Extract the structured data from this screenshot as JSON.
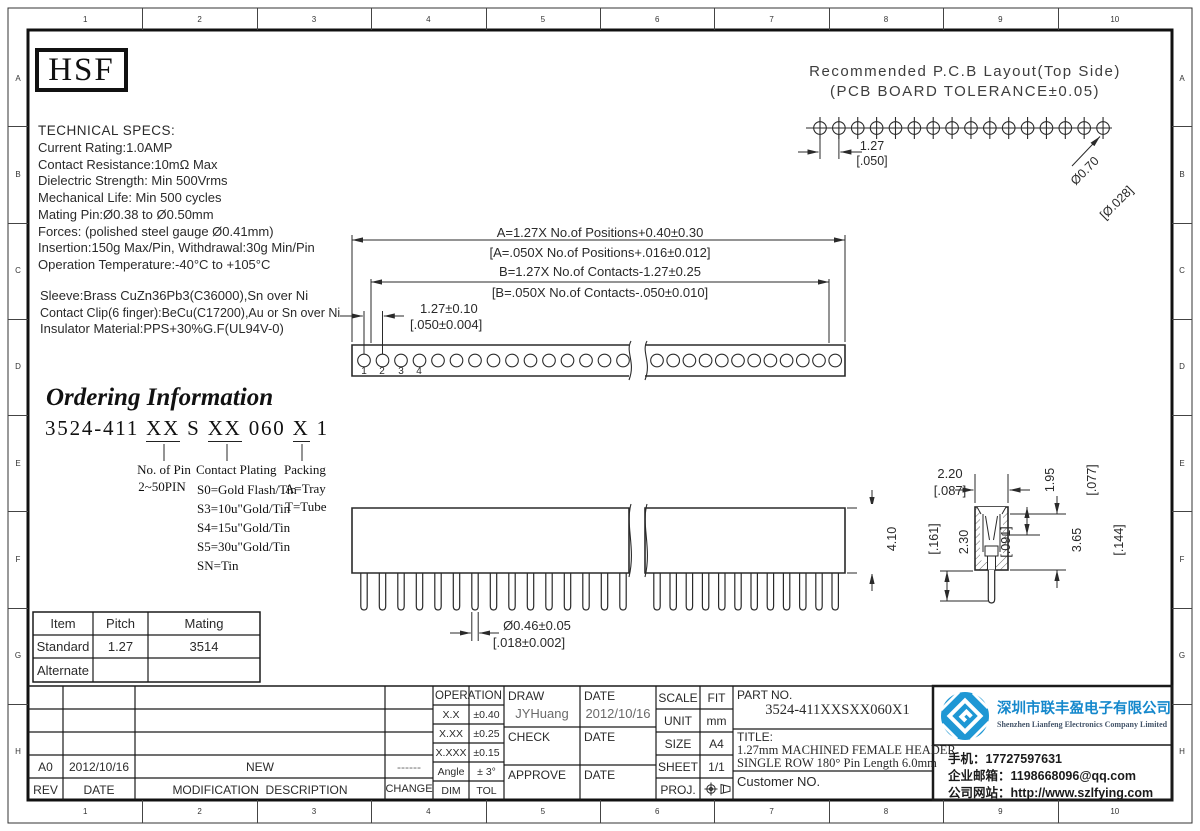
{
  "frame": {
    "top_numbers": [
      "1",
      "2",
      "3",
      "4",
      "5",
      "6",
      "7",
      "8",
      "9",
      "10"
    ],
    "side_letters": [
      "A",
      "B",
      "C",
      "D",
      "E",
      "F",
      "G",
      "H"
    ]
  },
  "logo_box": {
    "text": "HSF"
  },
  "pcb_layout": {
    "title_line1": "Recommended P.C.B Layout(Top Side)",
    "title_line2": "(PCB BOARD TOLERANCE±0.05)",
    "pitch_mm": "1.27",
    "pitch_in": "[.050]",
    "hole_dia_mm": "Ø0.70",
    "hole_dia_in": "[Ø.028]",
    "hole_count": 16
  },
  "tech_specs": {
    "title": "TECHNICAL SPECS:",
    "lines": [
      "Current Rating:1.0AMP",
      "Contact Resistance:10mΩ Max",
      "Dielectric Strength: Min 500Vrms",
      "Mechanical Life: Min 500 cycles",
      "Mating Pin:Ø0.38 to Ø0.50mm",
      "Forces: (polished steel gauge Ø0.41mm)",
      "Insertion:150g Max/Pin, Withdrawal:30g Min/Pin",
      "Operation Temperature:-40°C to +105°C"
    ],
    "material_lines": [
      "Sleeve:Brass CuZn36Pb3(C36000),Sn over Ni",
      "Contact Clip(6 finger):BeCu(C17200),Au or Sn over Ni",
      "Insulator Material:PPS+30%G.F(UL94V-0)"
    ]
  },
  "dimensions": {
    "a_metric": "A=1.27X No.of Positions+0.40±0.30",
    "a_inch": "[A=.050X No.of Positions+.016±0.012]",
    "b_metric": "B=1.27X No.of Contacts-1.27±0.25",
    "b_inch": "[B=.050X No.of Contacts-.050±0.010]",
    "pitch_metric": "1.27±0.10",
    "pitch_inch": "[.050±0.004]",
    "body_height_metric": "4.10",
    "body_height_inch": "[.161]",
    "pin_dia_metric": "Ø0.46±0.05",
    "pin_dia_inch": "[.018±0.002]",
    "width_metric": "2.20",
    "width_inch": "[.087]",
    "depth_metric": "1.95",
    "depth_inch": "[.077]",
    "tail_metric": "2.30",
    "tail_inch": "[.091]",
    "inner_metric": "3.65",
    "inner_inch": "[.144]"
  },
  "top_view": {
    "pin_numbers": [
      "1",
      "2",
      "3",
      "4"
    ],
    "left_holes": 15,
    "right_holes": 12
  },
  "side_view": {
    "left_pins": 15,
    "right_pins": 12
  },
  "ordering": {
    "title": "Ordering Information",
    "part_segments": [
      {
        "text": "3524-411 "
      },
      {
        "text": "XX"
      },
      {
        "text": " S "
      },
      {
        "text": "XX"
      },
      {
        "text": " 060 "
      },
      {
        "text": "X"
      },
      {
        "text": " 1"
      }
    ],
    "pin_label_title": "No. of Pin",
    "pin_label_value": "2~50PIN",
    "plating_title": "Contact Plating",
    "plating_options": [
      "S0=Gold Flash/Tin",
      "S3=10u\"Gold/Tin",
      "S4=15u\"Gold/Tin",
      "S5=30u\"Gold/Tin",
      "SN=Tin"
    ],
    "packing_title": "Packing",
    "packing_options": [
      "A=Tray",
      "T=Tube"
    ]
  },
  "mating_table": {
    "headers": [
      "Item",
      "Pitch",
      "Mating"
    ],
    "rows": [
      [
        "Standard",
        "1.27",
        "3514"
      ],
      [
        "Alternate",
        "",
        ""
      ]
    ]
  },
  "rev_table": {
    "rev": "A0",
    "date": "2012/10/16",
    "desc": "NEW",
    "change": "------",
    "headers": [
      "REV",
      "DATE",
      "MODIFICATION  DESCRIPTION",
      "CHANGE"
    ]
  },
  "tol_table": {
    "title": "OPERATION",
    "rows": [
      [
        "X.X",
        "±0.40"
      ],
      [
        "X.XX",
        "±0.25"
      ],
      [
        "X.XXX",
        "±0.15"
      ],
      [
        "Angle",
        "± 3°"
      ],
      [
        "DIM",
        "TOL"
      ]
    ]
  },
  "sign_block": {
    "draw_label": "DRAW",
    "draw_value": "JYHuang",
    "date1_label": "DATE",
    "date1_value": "2012/10/16",
    "check_label": "CHECK",
    "date2_label": "DATE",
    "approve_label": "APPROVE",
    "date3_label": "DATE"
  },
  "info_block": {
    "scale_label": "SCALE",
    "scale_value": "FIT",
    "unit_label": "UNIT",
    "unit_value": "mm",
    "size_label": "SIZE",
    "size_value": "A4",
    "sheet_label": "SHEET",
    "sheet_value": "1/1",
    "proj_label": "PROJ."
  },
  "part_block": {
    "part_no_label": "PART NO.",
    "part_no_value": "3524-411XXSXX060X1",
    "title_label": "TITLE:",
    "title_line1": "1.27mm MACHINED FEMALE HEADER",
    "title_line2": "SINGLE ROW 180° Pin Length 6.0mm",
    "customer_label": "Customer NO."
  },
  "company": {
    "name_cn": "深圳市联丰盈电子有限公司",
    "name_en": "Shenzhen Lianfeng Electronics Company Limited",
    "phone": "手机：17727597631",
    "email": "企业邮箱：1198668096@qq.com",
    "website": "公司网站：http://www.szlfying.com",
    "brand_color": "#1588cc"
  }
}
